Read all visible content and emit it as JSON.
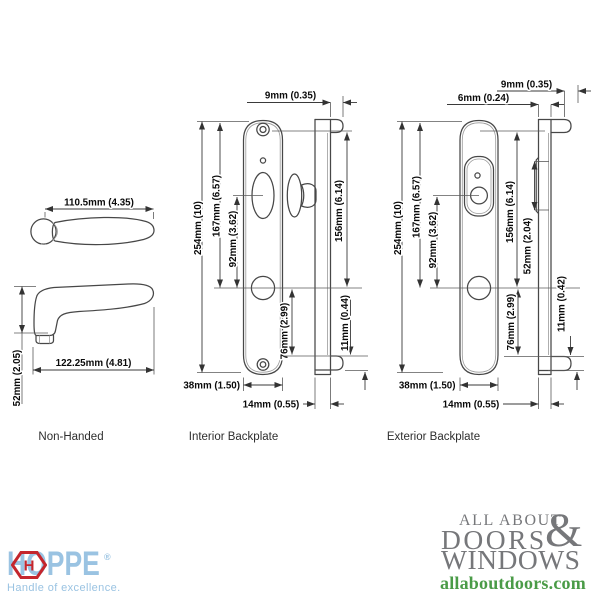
{
  "drawing": {
    "lever": {
      "label": "Non-Handed",
      "dims": {
        "top_width": "110.5mm (4.35)",
        "length": "122.25mm (4.81)",
        "height": "52mm (2.05)"
      }
    },
    "interior": {
      "label": "Interior Backplate",
      "dims": {
        "cap_offset": "9mm (0.35)",
        "total_height": "254mm (10)",
        "top_to_handle": "167mm (6.57)",
        "turn_to_handle": "92mm (3.62)",
        "side_top_to_handle": "156mm (6.14)",
        "handle_to_bottom": "76mm (2.99)",
        "end_cap": "11mm (0.44)",
        "plate_width": "38mm (1.50)",
        "side_width": "14mm (0.55)"
      }
    },
    "exterior": {
      "label": "Exterior Backplate",
      "dims": {
        "cap_offset": "9mm (0.35)",
        "plate_thickness": "6mm (0.24)",
        "total_height": "254mm (10)",
        "top_to_handle": "167mm (6.57)",
        "cylinder_to_handle": "92mm (3.62)",
        "side_top_to_handle": "156mm (6.14)",
        "cylinder_housing": "52mm (2.04)",
        "handle_to_bottom": "76mm (2.99)",
        "end_cap": "11mm (0.42)",
        "plate_width": "38mm (1.50)",
        "side_width": "14mm (0.55)"
      }
    }
  },
  "footer": {
    "hoppe": {
      "wordmark": "HOPPE",
      "registered": "®",
      "tagline": "Handle of excellence.",
      "hex_letter": "H",
      "blue": "#9AC3E2",
      "red": "#C4262D"
    },
    "aadw": {
      "line1": "ALL ABOUT",
      "ampersand": "&",
      "line2": "DOORS",
      "line3": "WINDOWS",
      "url": "allaboutdoors.com",
      "gray": "#76777A",
      "green": "#4A9B47"
    }
  }
}
